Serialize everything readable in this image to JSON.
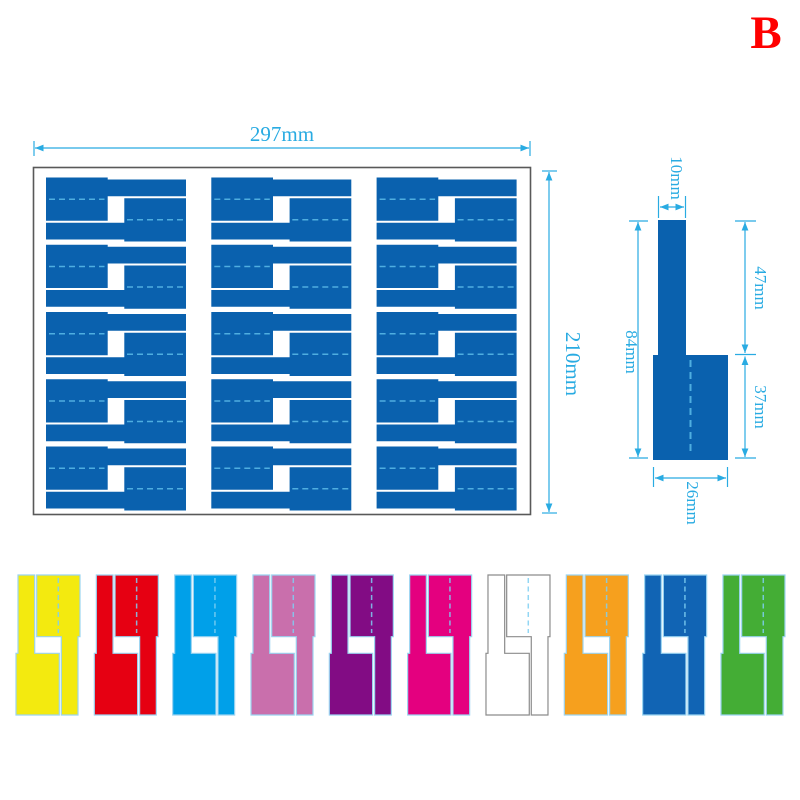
{
  "variant_label": "B",
  "accent_color": "#29ABE2",
  "sheet": {
    "width_label": "297mm",
    "height_label": "210mm",
    "border_color": "#595959",
    "label_color": "#0A61AE",
    "fold_color": "#4FAEE0",
    "columns": 3,
    "rows": 5,
    "labels_per_cell": 2
  },
  "single_label_diagram": {
    "fill": "#0A61AE",
    "fold_color": "#4FAEE0",
    "dims": {
      "stem_width": "10mm",
      "stem_length": "47mm",
      "total_length": "84mm",
      "base_length": "37mm",
      "base_width": "26mm"
    }
  },
  "variant_color": "#FF0000",
  "fold_dash_color": "#7FCFF2",
  "color_samples": [
    {
      "name": "yellow",
      "fill": "#F3EA0F",
      "stroke": "#9BD4F1"
    },
    {
      "name": "red",
      "fill": "#E60012",
      "stroke": "#9BD4F1"
    },
    {
      "name": "sky-blue",
      "fill": "#00A0E9",
      "stroke": "#9BD4F1"
    },
    {
      "name": "orchid",
      "fill": "#C96FAC",
      "stroke": "#9BD4F1"
    },
    {
      "name": "purple",
      "fill": "#820C84",
      "stroke": "#9BD4F1"
    },
    {
      "name": "magenta",
      "fill": "#E4007F",
      "stroke": "#9BD4F1"
    },
    {
      "name": "white",
      "fill": "#FFFFFF",
      "stroke": "#8C8C8C"
    },
    {
      "name": "orange",
      "fill": "#F6A01E",
      "stroke": "#9BD4F1"
    },
    {
      "name": "blue",
      "fill": "#1164B4",
      "stroke": "#9BD4F1"
    },
    {
      "name": "green",
      "fill": "#44AD35",
      "stroke": "#9BD4F1"
    }
  ]
}
